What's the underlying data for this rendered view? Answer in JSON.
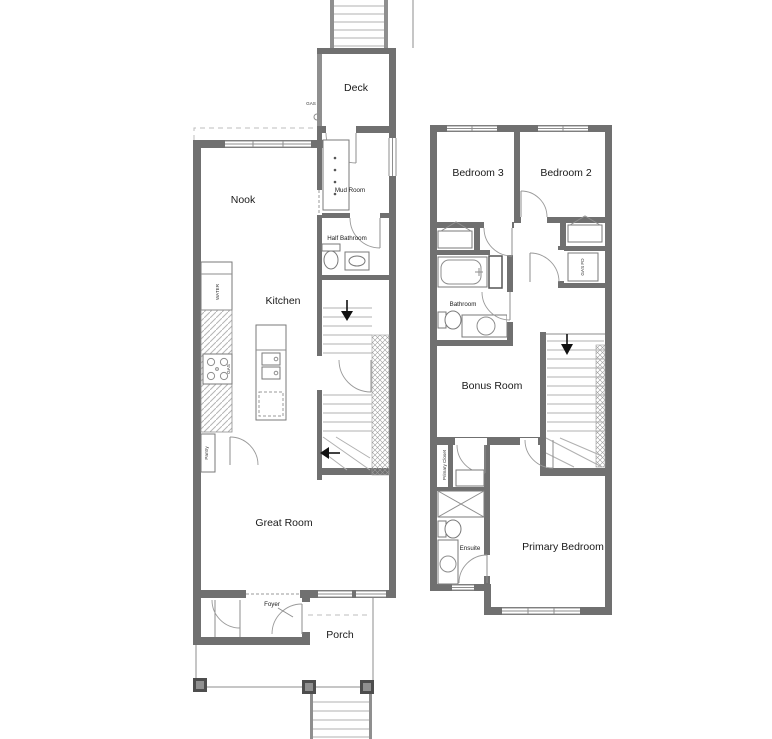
{
  "floor1": {
    "nook": "Nook",
    "kitchen": "Kitchen",
    "great_room": "Great Room",
    "deck": "Deck",
    "mud_room": "Mud Room",
    "half_bathroom": "Half Bathroom",
    "pantry": "Pantry",
    "foyer": "Foyer",
    "porch": "Porch",
    "water_label": "WATER",
    "gas_range_label": "GAS",
    "gas_meter_label": "GAS"
  },
  "floor2": {
    "bedroom3": "Bedroom 3",
    "bedroom2": "Bedroom 2",
    "bathroom": "Bathroom",
    "bonus_room": "Bonus Room",
    "primary_bedroom": "Primary Bedroom",
    "primary_closet": "Primary Closet",
    "ensuite": "Ensuite",
    "mech_label": "GAS FD"
  },
  "colors": {
    "wall": "#707070",
    "wall_dark": "#4d4d4d",
    "line_light": "#b0b0b0",
    "text": "#1a1a1a",
    "background": "#ffffff"
  }
}
